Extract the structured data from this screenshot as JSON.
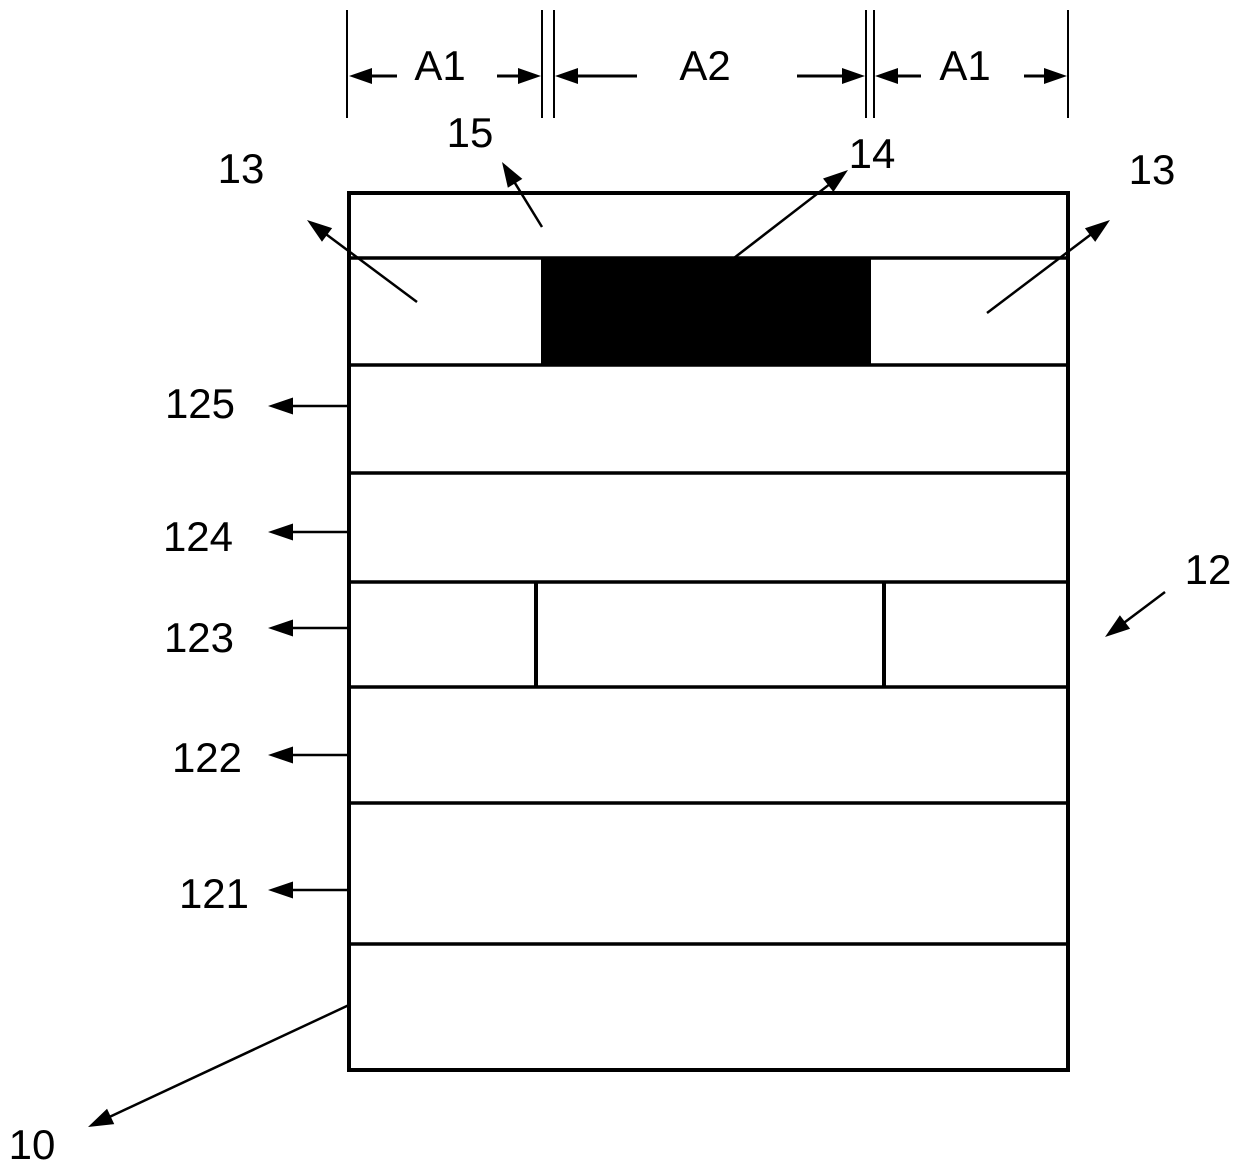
{
  "figure": {
    "description": "Patent-style cross-section diagram of a layered device stack with dimension lines A1/A2/A1 and reference numerals",
    "canvas": {
      "width": 1240,
      "height": 1171,
      "background": "#ffffff",
      "line_color": "#000000",
      "black_fill": "#000000"
    },
    "device_box": {
      "x": 349,
      "y": 193,
      "width": 719,
      "height": 877
    },
    "layer_boundaries_y": [
      258,
      365,
      473,
      582,
      687,
      803,
      944
    ],
    "black_region": {
      "x": 541,
      "y": 258,
      "width": 330,
      "height": 107
    },
    "inner_dividers": [
      {
        "x": 536,
        "y1": 582,
        "y2": 687
      },
      {
        "x": 884,
        "y1": 582,
        "y2": 687
      }
    ],
    "dimensions": {
      "extension_lines_x": [
        347,
        542,
        554,
        866,
        874,
        1068
      ],
      "extension_y1": 10,
      "extension_y2": 118,
      "arrow_y": 76,
      "arrows": [
        {
          "x1": 397,
          "x2": 349
        },
        {
          "x1": 497,
          "x2": 541
        },
        {
          "x1": 637,
          "x2": 555
        },
        {
          "x1": 797,
          "x2": 865
        },
        {
          "x1": 921,
          "x2": 875
        },
        {
          "x1": 1024,
          "x2": 1067
        }
      ]
    },
    "leaders": [
      {
        "name": "leader-arrow-15",
        "x1": 542,
        "y1": 227,
        "x2": 502,
        "y2": 162
      },
      {
        "name": "leader-arrow-14",
        "x1": 734,
        "y1": 258,
        "x2": 848,
        "y2": 170
      },
      {
        "name": "leader-arrow-13-left",
        "x1": 417,
        "y1": 302,
        "x2": 307,
        "y2": 220
      },
      {
        "name": "leader-arrow-13-right",
        "x1": 987,
        "y1": 313,
        "x2": 1110,
        "y2": 220
      },
      {
        "name": "leader-arrow-12",
        "x1": 1165,
        "y1": 592,
        "x2": 1105,
        "y2": 637
      },
      {
        "name": "leader-arrow-10",
        "x1": 349,
        "y1": 1005,
        "x2": 88,
        "y2": 1127
      },
      {
        "name": "leader-arrow-125",
        "x1": 351,
        "y1": 406,
        "x2": 268,
        "y2": 406
      },
      {
        "name": "leader-arrow-124",
        "x1": 351,
        "y1": 532,
        "x2": 268,
        "y2": 532
      },
      {
        "name": "leader-arrow-123",
        "x1": 351,
        "y1": 628,
        "x2": 268,
        "y2": 628
      },
      {
        "name": "leader-arrow-122",
        "x1": 351,
        "y1": 755,
        "x2": 268,
        "y2": 755
      },
      {
        "name": "leader-arrow-121",
        "x1": 351,
        "y1": 890,
        "x2": 268,
        "y2": 890
      }
    ],
    "labels": [
      {
        "name": "label-a1-left",
        "text": "A1",
        "x": 440,
        "y": 80
      },
      {
        "name": "label-a2",
        "text": "A2",
        "x": 705,
        "y": 80
      },
      {
        "name": "label-a1-right",
        "text": "A1",
        "x": 965,
        "y": 80
      },
      {
        "name": "label-15",
        "text": "15",
        "x": 470,
        "y": 147
      },
      {
        "name": "label-14",
        "text": "14",
        "x": 872,
        "y": 168
      },
      {
        "name": "label-13-left",
        "text": "13",
        "x": 241,
        "y": 183
      },
      {
        "name": "label-13-right",
        "text": "13",
        "x": 1152,
        "y": 184
      },
      {
        "name": "label-125",
        "text": "125",
        "x": 200,
        "y": 418
      },
      {
        "name": "label-124",
        "text": "124",
        "x": 198,
        "y": 551
      },
      {
        "name": "label-123",
        "text": "123",
        "x": 199,
        "y": 652
      },
      {
        "name": "label-122",
        "text": "122",
        "x": 207,
        "y": 772
      },
      {
        "name": "label-121",
        "text": "121",
        "x": 214,
        "y": 908
      },
      {
        "name": "label-12",
        "text": "12",
        "x": 1208,
        "y": 584
      },
      {
        "name": "label-10",
        "text": "10",
        "x": 32,
        "y": 1159
      }
    ],
    "styles": {
      "label_font_size": 42,
      "outer_stroke": 4,
      "boundary_stroke": 3.5,
      "divider_stroke": 4,
      "extension_stroke": 2,
      "leader_stroke": 2.5,
      "dim_stroke": 3,
      "leader_head_len": 25,
      "leader_head_w": 17,
      "dim_head_len": 23,
      "dim_head_w": 16
    }
  }
}
